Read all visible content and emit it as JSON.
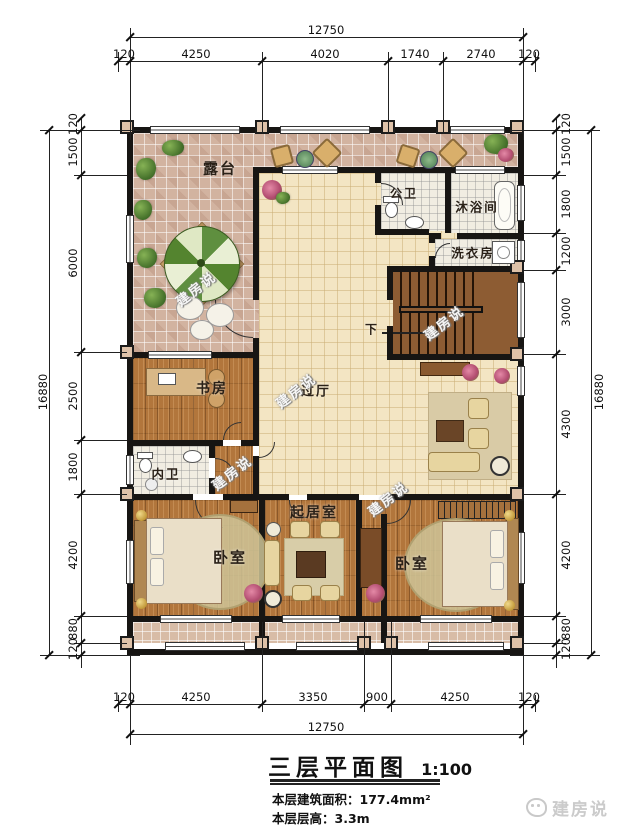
{
  "title": {
    "text": "三层平面图",
    "scale": "1:100"
  },
  "info": {
    "area_label": "本层建筑面积：",
    "area_value": "177.4mm²",
    "height_label": "本层层高：",
    "height_value": "3.3m"
  },
  "rooms": {
    "terrace": "露台",
    "public_bath": "公卫",
    "shower": "沐浴间",
    "laundry": "洗衣房",
    "hall": "过厅",
    "study": "书房",
    "inner_bath": "内卫",
    "living": "起居室",
    "bedroom_left": "卧室",
    "bedroom_right": "卧室",
    "stairs_down": "下"
  },
  "dims": {
    "top": {
      "total": "12750",
      "segments": [
        "120",
        "4250",
        "4020",
        "1740",
        "2740",
        "120"
      ]
    },
    "bottom": {
      "total": "12750",
      "segments": [
        "120",
        "4250",
        "3350",
        "900",
        "4250",
        "120"
      ]
    },
    "left": {
      "total": "16880",
      "segments": [
        "120",
        "1500",
        "6000",
        "2500",
        "1800",
        "4200",
        "880",
        "120"
      ]
    },
    "right": {
      "total": "16880",
      "segments": [
        "120",
        "1500",
        "1800",
        "1200",
        "3000",
        "4300",
        "4200",
        "880",
        "120"
      ]
    }
  },
  "watermark": {
    "text": "建房说"
  },
  "logo": {
    "text": "建房说"
  },
  "colors": {
    "wall": "#171513",
    "wood": "#b2763c",
    "terrace_tile": "#d2b3a0",
    "hall_tile": "#f3e5c3",
    "umbrella_green": "#5f8f3f"
  }
}
